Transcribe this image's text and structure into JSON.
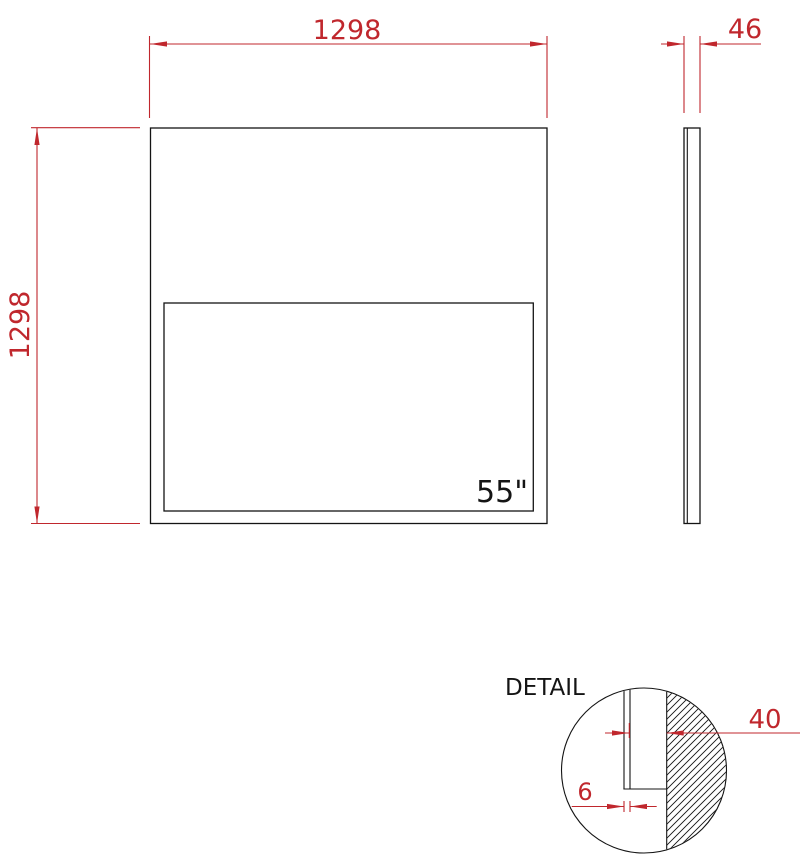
{
  "colors": {
    "dimension_red": "#c0272d",
    "outline_black": "#141414",
    "background": "#ffffff"
  },
  "front_view": {
    "width_dimension": "1298",
    "height_dimension": "1298",
    "screen_size_label": "55\""
  },
  "side_view": {
    "thickness_dimension": "46"
  },
  "detail_view": {
    "title": "DETAIL",
    "body_depth_dimension": "40",
    "glass_thickness_dimension": "6"
  }
}
